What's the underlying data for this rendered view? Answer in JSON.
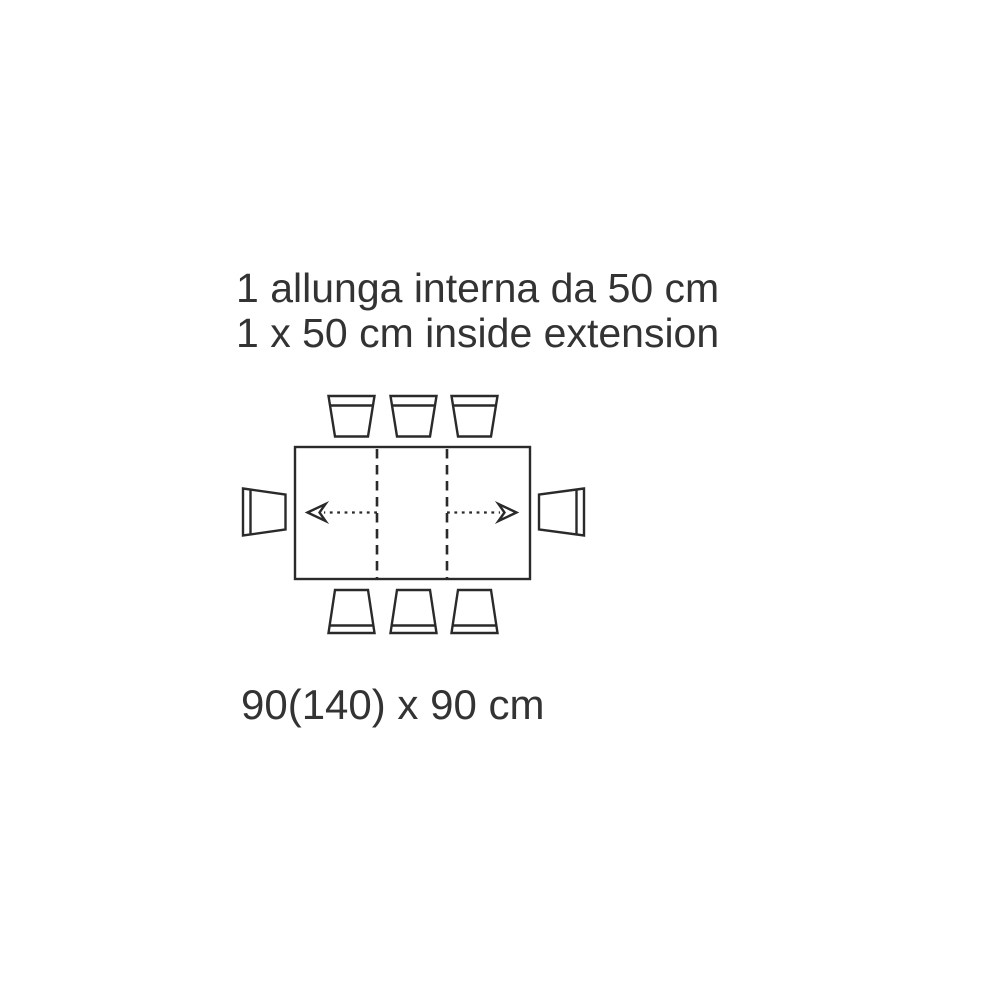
{
  "colors": {
    "background": "#ffffff",
    "line": "#2a2a2a",
    "text": "#333333"
  },
  "caption": {
    "line1": "1 allunga interna da 50 cm",
    "line2": "1 x 50 cm inside extension"
  },
  "figure": {
    "type": "extendable-table-plan-view",
    "seats_total": 8,
    "chairs_top": 3,
    "chairs_bottom": 3,
    "chairs_left": 1,
    "chairs_right": 1,
    "fold_lines": 2,
    "extension_arrows": 2
  },
  "dimensions_label": "90(140) x 90 cm"
}
